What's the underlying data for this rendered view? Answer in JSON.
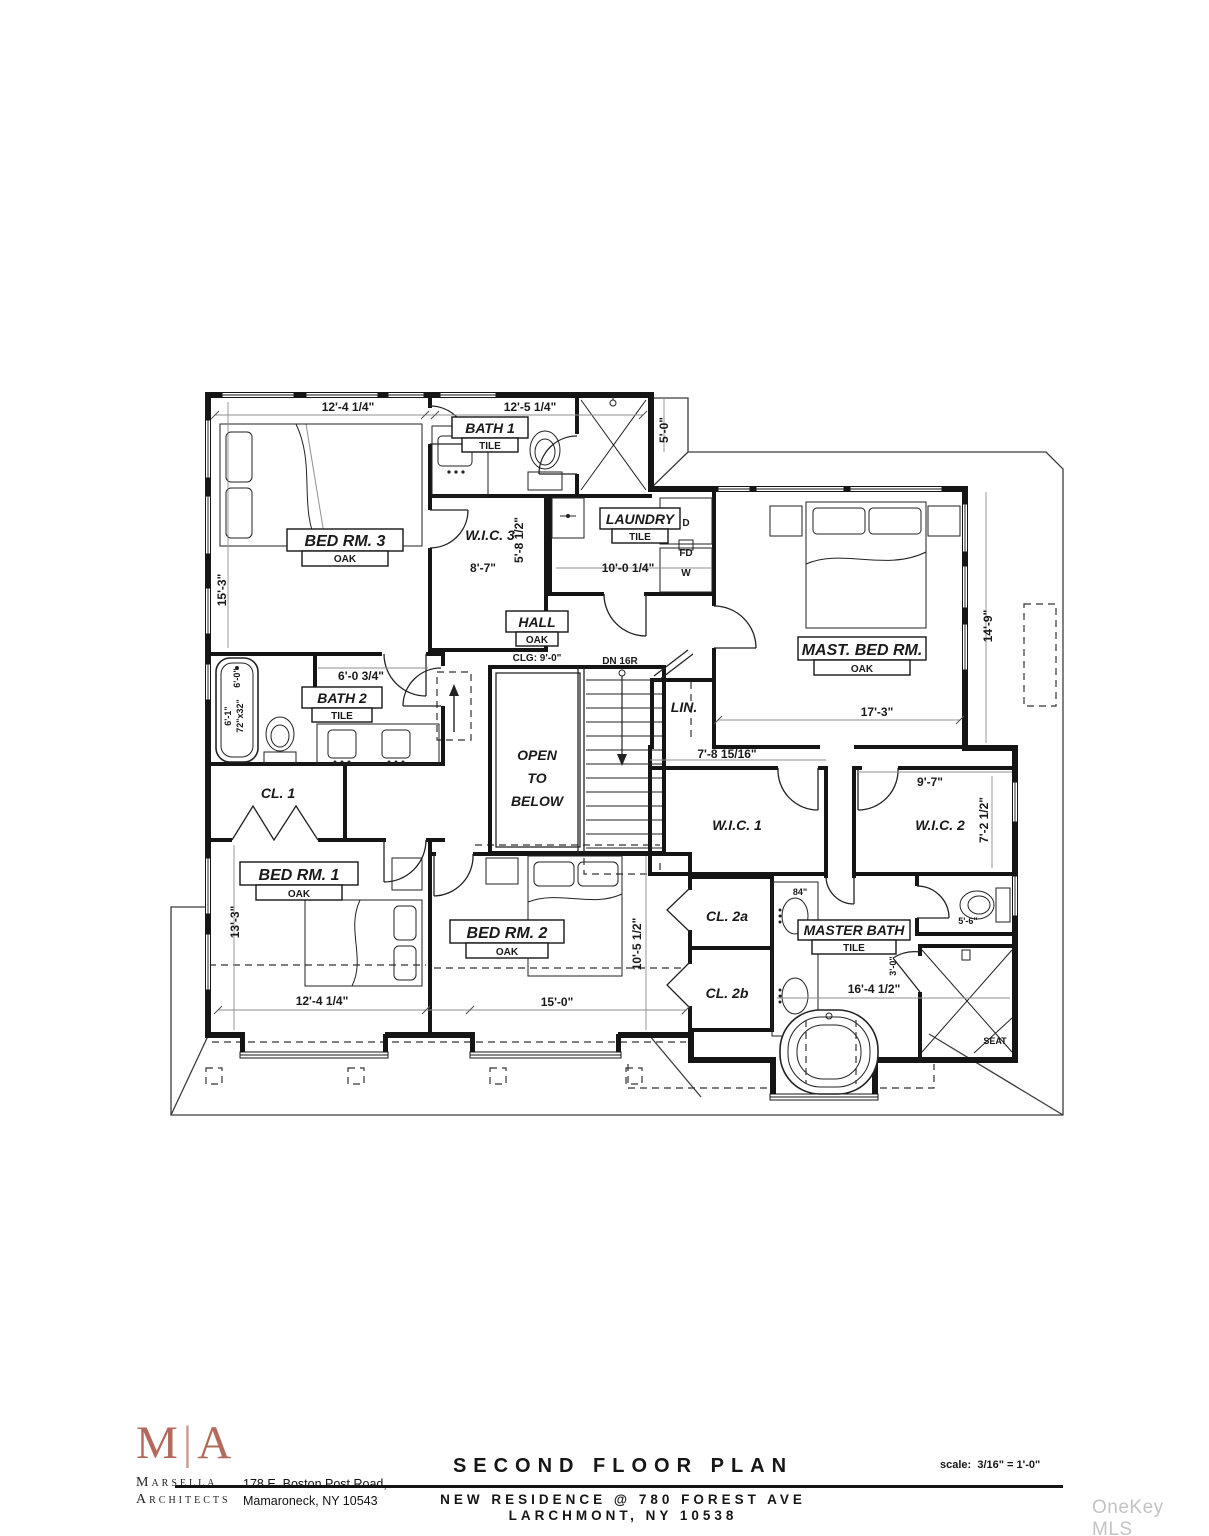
{
  "watermark": "OneKey MLS",
  "title_block": {
    "logo": {
      "m": "M",
      "bar": "|",
      "a": "A"
    },
    "firm_name_line1": "Marsella",
    "firm_name_line2": "Architects",
    "address_line1": "178 E. Boston Post Road,",
    "address_line2": "Mamaroneck, NY 10543",
    "drawing_title": "SECOND FLOOR PLAN",
    "project_line1": "NEW RESIDENCE @ 780 FOREST AVE",
    "project_line2": "LARCHMONT, NY 10538",
    "scale_label": "scale:",
    "scale_value": "3/16\" = 1'-0\""
  },
  "rooms": {
    "bed3": {
      "name": "BED RM. 3",
      "floor": "OAK"
    },
    "bath1": {
      "name": "BATH 1",
      "floor": "TILE"
    },
    "wic3": {
      "name": "W.I.C. 3"
    },
    "laundry": {
      "name": "LAUNDRY",
      "floor": "TILE"
    },
    "hall": {
      "name": "HALL",
      "floor": "OAK"
    },
    "master": {
      "name": "MAST. BED RM.",
      "floor": "OAK"
    },
    "lin": {
      "name": "LIN."
    },
    "open_below": {
      "line1": "OPEN",
      "line2": "TO",
      "line3": "BELOW"
    },
    "bath2": {
      "name": "BATH 2",
      "floor": "TILE"
    },
    "cl1": {
      "name": "CL. 1"
    },
    "bed1": {
      "name": "BED RM. 1",
      "floor": "OAK"
    },
    "bed2": {
      "name": "BED RM. 2",
      "floor": "OAK"
    },
    "cl2a": {
      "name": "CL. 2a"
    },
    "cl2b": {
      "name": "CL. 2b"
    },
    "wic1": {
      "name": "W.I.C. 1"
    },
    "wic2": {
      "name": "W.I.C. 2"
    },
    "masterbath": {
      "name": "MASTER BATH",
      "floor": "TILE"
    }
  },
  "dims": {
    "bed3_w": "12'-4 1/4\"",
    "bath1_w": "12'-5 1/4\"",
    "bed3_h": "15'-3\"",
    "bump_h": "5'-0\"",
    "wic3_w": "8'-7\"",
    "wic3_h": "5'-8 1/2\"",
    "laundry_w": "10'-0 1/4\"",
    "bath2_w": "6'-0 3/4\"",
    "bath2_h": "6'-0\"",
    "tub2_l": "6'-1\"",
    "tub2_size": "72\"x32\"",
    "master_w": "17'-3\"",
    "master_h": "14'-9\"",
    "wic1_w": "7'-8 15/16\"",
    "wic2_w": "9'-7\"",
    "wic2_h": "7'-2 1/2\"",
    "bed1_h": "13'-3\"",
    "bed1_w": "12'-4 1/4\"",
    "bed2_w": "15'-0\"",
    "bed2_h": "10'-5 1/2\"",
    "wc_w": "5'-6\"",
    "vanity_w": "84\"",
    "mbath_w": "16'-4 1/2\"",
    "shower_door": "3'-0\""
  },
  "annotations": {
    "ceiling": "CLG: 9'-0\"",
    "stair_direction": "DN 16R",
    "dryer": "D",
    "washer": "W",
    "floor_drain": "FD",
    "shower_seat": "SEAT"
  }
}
